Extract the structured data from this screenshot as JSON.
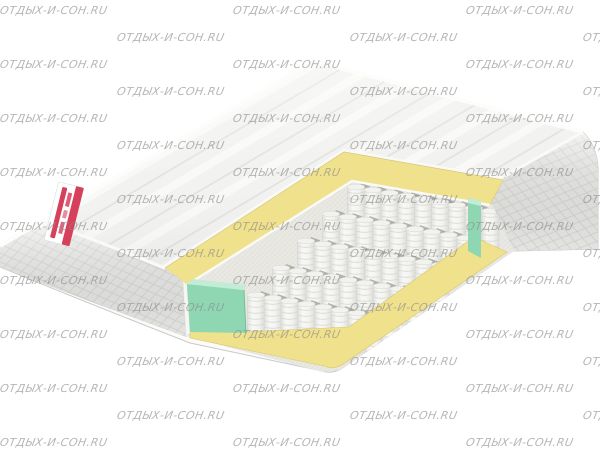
{
  "watermark": {
    "text": "отдых-и-сон.ru",
    "color": "#8a8a8a",
    "opacity": 0.62,
    "font_size_px": 11,
    "row_start_y": 4,
    "row_spacing_px": 27,
    "rows": 17,
    "columns_even": [
      0,
      233,
      466
    ],
    "columns_odd": [
      117,
      350,
      583
    ]
  },
  "palette": {
    "background": "#ffffff",
    "base_white": "#fbfbf9",
    "top_fabric": "#f2f2f0",
    "side_fabric": "#f0f0ee",
    "floor": "#e9e8e3",
    "foam_yellow": "#f0e18c",
    "foam_green": "#8fd7b2",
    "foam_green_light": "#c2ecd5",
    "label_red": "#d7405a"
  },
  "springs": {
    "rows": 5,
    "per_row": 9
  }
}
